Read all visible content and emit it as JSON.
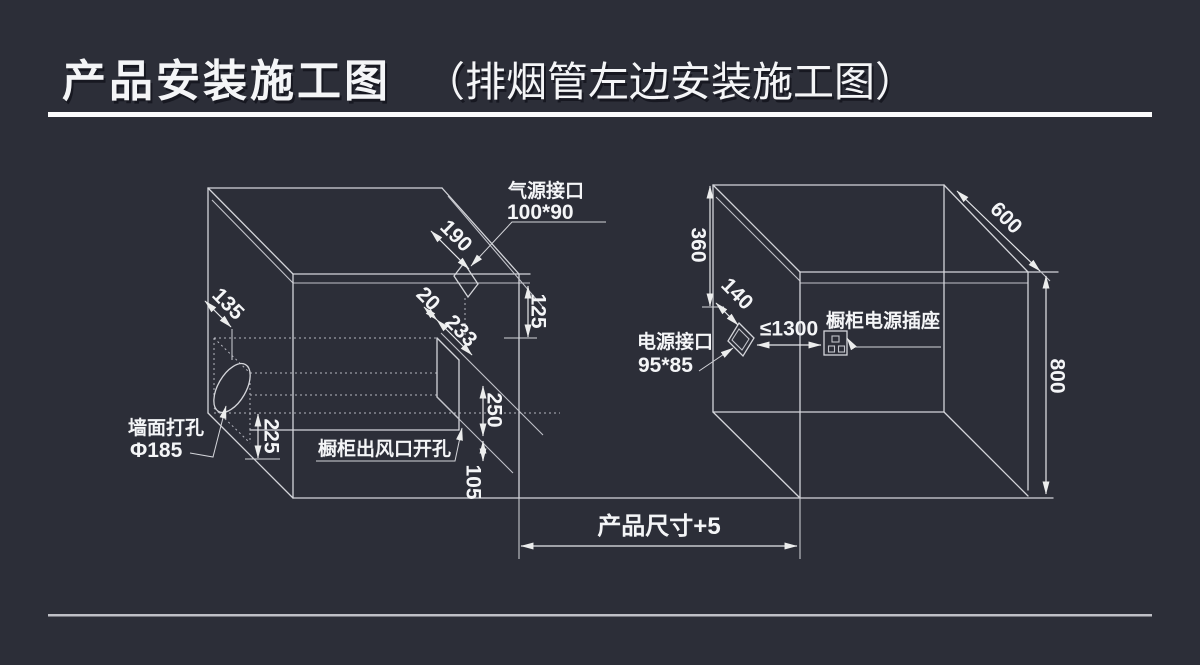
{
  "title": {
    "main": "产品安装施工图",
    "paren": "（排烟管左边安装施工图）"
  },
  "left_box": {
    "gas_port_label": {
      "line1": "气源接口",
      "line2": "100*90"
    },
    "wall_hole_label": {
      "line1": "墙面打孔",
      "line2": "Φ185"
    },
    "outlet_label": "橱柜出风口开孔",
    "dims": {
      "d190": "190",
      "d20": "20",
      "d233": "233",
      "d125": "125",
      "d135": "135",
      "d225": "225",
      "d250": "250",
      "d105": "105"
    }
  },
  "right_box": {
    "power_port_label": {
      "line1": "电源接口",
      "line2": "95*85"
    },
    "socket_label": "橱柜电源插座",
    "dims": {
      "d360": "360",
      "d140": "140",
      "d600": "600",
      "d800": "800",
      "d1300": "≤1300"
    }
  },
  "footer": {
    "product_size": "产品尺寸+5"
  },
  "colors": {
    "background": "#2c2e38",
    "line": "#d4d5da",
    "text": "#f4f5f7",
    "rule_top": "#fbfbfc",
    "rule_bottom": "#bfc0c6"
  }
}
